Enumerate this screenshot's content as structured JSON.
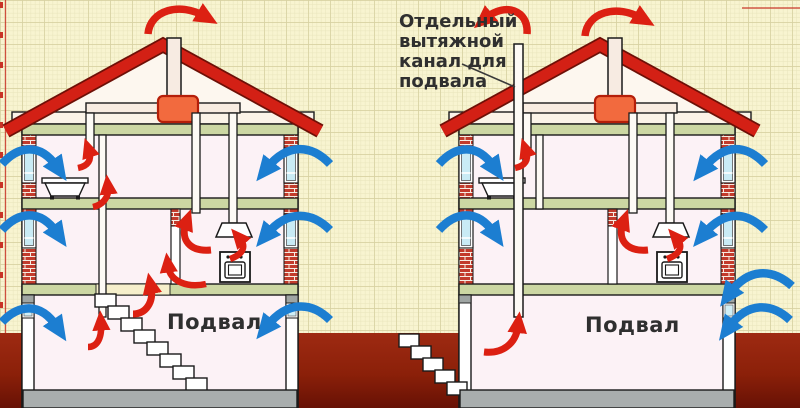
{
  "diagram": {
    "callout_text": "Отдельный\nвытяжной\nканал для\nподвала",
    "houses": [
      {
        "id": "left",
        "scheme": "exhaust through house ducts and stair opening",
        "basement_label": "Подвал"
      },
      {
        "id": "right",
        "scheme": "separate exhaust channel for basement",
        "basement_label": "Подвал"
      }
    ],
    "colors": {
      "paper": "#f8f4d0",
      "grid": "#e9e5bc",
      "margin_line": "#c93326",
      "ground_top": "#9e2a12",
      "ground_bottom": "#671105",
      "roof": "#d32015",
      "slab_green": "#ccd7a3",
      "brick": "#c23b2c",
      "window_glass": "#c9ebf5",
      "attic_box": "#f26a3e",
      "red_arrow": "#dc2012",
      "blue_arrow": "#1c7ed1",
      "label_text": "#2f2f2f"
    }
  }
}
